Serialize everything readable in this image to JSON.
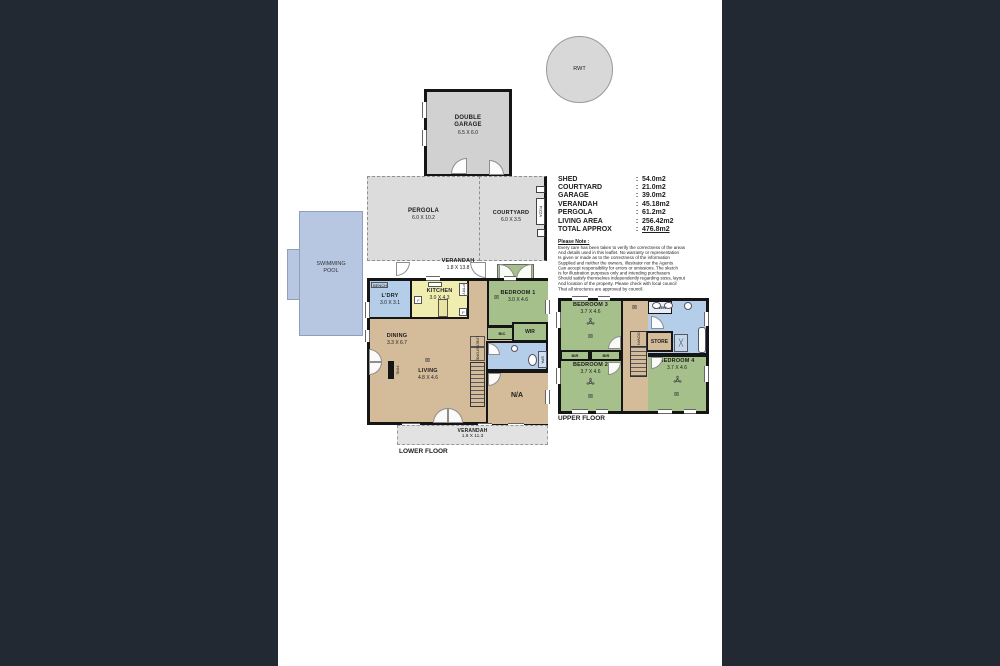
{
  "colors": {
    "background": "#222932",
    "paper": "#ffffff",
    "wall": "#151515",
    "pool_fill": "#b7c7e1",
    "outdoor_gray": "#dcdcdc",
    "room_tan": "#d4bb9a",
    "room_green": "#a5c08b",
    "room_blue": "#b4cde9",
    "room_yellow": "#f0edb0"
  },
  "icons": {
    "light": "⊠",
    "shower_x": "╳"
  },
  "rwt_label": "RWT",
  "garage": {
    "name1": "DOUBLE",
    "name2": "GARAGE",
    "size": "6.5 X 6.0"
  },
  "pergola": {
    "name": "PERGOLA",
    "size": "6.0 X 10.2"
  },
  "courtyard": {
    "name": "COURTYARD",
    "size": "6.0 X 3.5"
  },
  "pizza_label": "PIZZA",
  "pool": {
    "line1": "SWIMMING",
    "line2": "POOL"
  },
  "verandah_top": {
    "name": "VERANDAH",
    "size": "1.8 X 13.8"
  },
  "verandah_bottom": {
    "name": "VERANDAH",
    "size": "1.8 X 11.3"
  },
  "floor_labels": {
    "lower": "LOWER FLOOR",
    "upper": "UPPER FLOOR"
  },
  "lower": {
    "ldry": {
      "name": "L'DRY",
      "size": "3.0 X 3.1"
    },
    "bench": "BENCH",
    "kitchen": {
      "name": "KITCHEN",
      "size": "3.0 X 4.3"
    },
    "ptry": "PTRY",
    "fridge": "F",
    "bedroom1": {
      "name": "BEDROOM 1",
      "size": "3.0 X 4.6"
    },
    "bic": "BIC",
    "wir": "WIR",
    "dining": {
      "name": "DINING",
      "size": "3.3 X 6.7"
    },
    "living": {
      "name": "LIVING",
      "size": "4.8 X 4.6"
    },
    "linen": "LINEN",
    "store": "STORE",
    "fire": "FIRE",
    "na": "N/A",
    "spa": "SPA"
  },
  "upper": {
    "bedroom3": {
      "name": "BEDROOM 3",
      "size": "3.7 X 4.6"
    },
    "bedroom2": {
      "name": "BEDROOM 2",
      "size": "3.7 X 4.6"
    },
    "bedroom4": {
      "name": "BEDROOM 4",
      "size": "3.7 X 4.6"
    },
    "bir_left": "BIR",
    "bir_right": "BIR",
    "linen": "LINEN",
    "store": "STORE",
    "down": "DOWN"
  },
  "areas": {
    "rows": [
      {
        "label": "SHED",
        "sep": ":",
        "value": "54.0m2"
      },
      {
        "label": "COURTYARD",
        "sep": ":",
        "value": "21.0m2"
      },
      {
        "label": "GARAGE",
        "sep": ":",
        "value": "39.0m2"
      },
      {
        "label": "VERANDAH",
        "sep": ":",
        "value": "45.18m2"
      },
      {
        "label": "PERGOLA",
        "sep": ":",
        "value": "61.2m2"
      },
      {
        "label": "LIVING AREA",
        "sep": ":",
        "value": "256.42m2"
      },
      {
        "label": "TOTAL APPROX",
        "sep": ":",
        "value": "476.8m2"
      }
    ]
  },
  "note": {
    "title": "Please Note :",
    "lines": [
      "Every care has been taken to verify the correctness of the areas",
      "And details used in this leaflet. No warranty or representation",
      "Is given or made as to the correctness of the information",
      "Supplied and neither the owners, illustrator nor the Agents",
      "Can accept responsibility for errors or omissions. The sketch",
      "Is for illustration purposes only and intending purchasers",
      "Should satisfy themselves independently regarding sizes, layout",
      "And location of the property. Please check with local council",
      "That all structures are approved by council."
    ]
  }
}
